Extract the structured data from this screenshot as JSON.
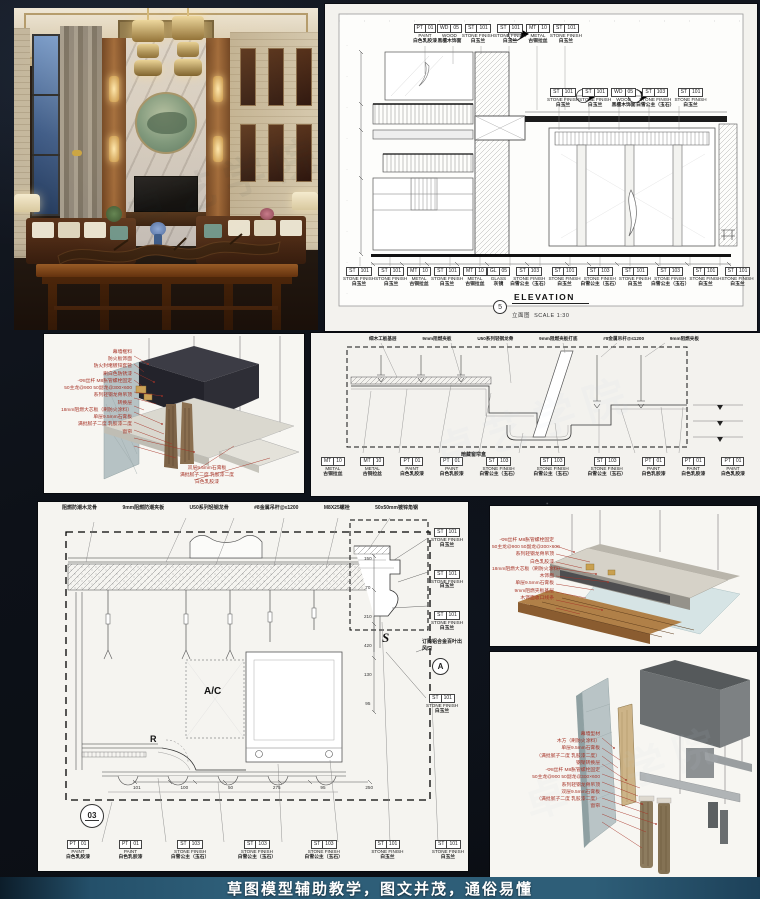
{
  "colors": {
    "background": "#0d1118",
    "panel_paper": "#f3f2ee",
    "banner_bg": "#2e5e78",
    "banner_text": "#ffffff",
    "annotation_red": "#a63226",
    "linework": "#222222"
  },
  "banner": {
    "text": "草图模型辅助教学，图文并茂，通俗易懂"
  },
  "watermark": {
    "text": "卓艺学院"
  },
  "elevation": {
    "title": "ELEVATION",
    "title_zh": "立面图",
    "scale": "SCALE 1:30",
    "detail_no": "5",
    "top_callouts": [
      {
        "c1": "PT",
        "c2": "01",
        "type": "PAINT",
        "zh": "白色乳胶漆"
      },
      {
        "c1": "WD",
        "c2": "05",
        "type": "WOOD",
        "zh": "黑檀木饰面"
      },
      {
        "c1": "ST",
        "c2": "101",
        "type": "STONE FINISH",
        "zh": "白玉兰"
      },
      {
        "c1": "ST",
        "c2": "101",
        "type": "STONE FINISH",
        "zh": "白玉兰"
      },
      {
        "c1": "MT",
        "c2": "10",
        "type": "METAL",
        "zh": "古铜拉丝"
      },
      {
        "c1": "ST",
        "c2": "101",
        "type": "STONE FINISH",
        "zh": "白玉兰"
      }
    ],
    "mid_callouts": [
      {
        "c1": "ST",
        "c2": "101",
        "type": "STONE FINISH",
        "zh": "白玉兰"
      },
      {
        "c1": "ST",
        "c2": "101",
        "type": "STONE FINISH",
        "zh": "白玉兰"
      },
      {
        "c1": "WD",
        "c2": "05",
        "type": "WOOD",
        "zh": "黑檀木饰面"
      },
      {
        "c1": "ST",
        "c2": "103",
        "type": "STONE FINISH",
        "zh": "白雪公主（玉石）"
      },
      {
        "c1": "ST",
        "c2": "101",
        "type": "STONE FINISH",
        "zh": "白玉兰"
      }
    ],
    "bottom_callouts": [
      {
        "c1": "ST",
        "c2": "101",
        "type": "STONE FINISH",
        "zh": "白玉兰"
      },
      {
        "c1": "ST",
        "c2": "101",
        "type": "STONE FINISH",
        "zh": "白玉兰"
      },
      {
        "c1": "MT",
        "c2": "10",
        "type": "METAL",
        "zh": "古铜拉丝"
      },
      {
        "c1": "ST",
        "c2": "101",
        "type": "STONE FINISH",
        "zh": "白玉兰"
      },
      {
        "c1": "MT",
        "c2": "10",
        "type": "METAL",
        "zh": "古铜拉丝"
      },
      {
        "c1": "GL",
        "c2": "05",
        "type": "GLASS",
        "zh": "灰镜"
      },
      {
        "c1": "ST",
        "c2": "103",
        "type": "STONE FINISH",
        "zh": "白雪公主（玉石）"
      },
      {
        "c1": "ST",
        "c2": "101",
        "type": "STONE FINISH",
        "zh": "白玉兰"
      },
      {
        "c1": "ST",
        "c2": "103",
        "type": "STONE FINISH",
        "zh": "白雪公主（玉石）"
      },
      {
        "c1": "ST",
        "c2": "101",
        "type": "STONE FINISH",
        "zh": "白玉兰"
      },
      {
        "c1": "ST",
        "c2": "103",
        "type": "STONE FINISH",
        "zh": "白雪公主（玉石）"
      },
      {
        "c1": "ST",
        "c2": "101",
        "type": "STONE FINISH",
        "zh": "白玉兰"
      },
      {
        "c1": "ST",
        "c2": "101",
        "type": "STONE FINISH",
        "zh": "白玉兰"
      }
    ]
  },
  "ceiling3d": {
    "annotations": [
      "幕墙框料",
      "防火板饰面",
      "防火封堵镀锌套管",
      "刷白色防锈漆",
      "-Φ8丝杆 M8胀管螺栓固定",
      "50主龙@900 50副龙@300×600",
      "系列轻钢龙骨吊顶",
      "转换层",
      "18mm阻燃大芯板（刷防火涂料）",
      "单层9.5mm石膏板",
      "满批腻子二度 乳胶漆二度",
      "窗帘"
    ],
    "note": [
      "双层9.5mm石膏板",
      "满批腻子二度 乳胶漆二度",
      "白色乳胶漆"
    ]
  },
  "section": {
    "top_labels": [
      "细木工板基层",
      "9mm阻燃夹板",
      "U50系列轻钢龙骨",
      "9mm阻燃夹板打底",
      "#8金属吊杆@≤1200",
      "9mm阻燃夹板"
    ],
    "note": "暗藏窗帘盒",
    "bottom_callouts": [
      {
        "c1": "MT",
        "c2": "10",
        "type": "METAL",
        "zh": "古铜拉丝"
      },
      {
        "c1": "MT",
        "c2": "10",
        "type": "METAL",
        "zh": "古铜拉丝"
      },
      {
        "c1": "PT",
        "c2": "01",
        "type": "PAINT",
        "zh": "白色乳胶漆"
      },
      {
        "c1": "PT",
        "c2": "01",
        "type": "PAINT",
        "zh": "白色乳胶漆"
      },
      {
        "c1": "ST",
        "c2": "103",
        "type": "STONE FINISH",
        "zh": "白雪公主（玉石）"
      },
      {
        "c1": "ST",
        "c2": "103",
        "type": "STONE FINISH",
        "zh": "白雪公主（玉石）"
      },
      {
        "c1": "ST",
        "c2": "103",
        "type": "STONE FINISH",
        "zh": "白雪公主（玉石）"
      },
      {
        "c1": "PT",
        "c2": "01",
        "type": "PAINT",
        "zh": "白色乳胶漆"
      },
      {
        "c1": "PT",
        "c2": "01",
        "type": "PAINT",
        "zh": "白色乳胶漆"
      },
      {
        "c1": "PT",
        "c2": "01",
        "type": "PAINT",
        "zh": "白色乳胶漆"
      }
    ]
  },
  "big_section": {
    "top_labels": [
      "阻燃防潮木龙骨",
      "9mm阻燃防潮夹板",
      "U50系列轻钢龙骨",
      "#8金属吊杆@≤1200",
      "M8X25螺栓",
      "50x50mm镀锌角钢"
    ],
    "right_callouts": [
      {
        "c1": "ST",
        "c2": "101",
        "type": "STONE FINISH",
        "zh": "白玉兰"
      },
      {
        "c1": "ST",
        "c2": "101",
        "type": "STONE FINISH",
        "zh": "白玉兰"
      },
      {
        "c1": "ST",
        "c2": "101",
        "type": "STONE FINISH",
        "zh": "白玉兰"
      }
    ],
    "lower_right_callout": {
      "c1": "ST",
      "c2": "101",
      "type": "STONE FINISH",
      "zh": "白玉兰"
    },
    "vent_label": "订购铝合金百叶出风口",
    "ac": "A/C",
    "r": "R",
    "s": "S",
    "detail_no": "03",
    "section_letter": "A",
    "bottom_callouts": [
      {
        "c1": "PT",
        "c2": "01",
        "type": "PAINT",
        "zh": "白色乳胶漆"
      },
      {
        "c1": "PT",
        "c2": "01",
        "type": "PAINT",
        "zh": "白色乳胶漆"
      },
      {
        "c1": "ST",
        "c2": "103",
        "type": "STONE FINISH",
        "zh": "白雪公主（玉石）"
      },
      {
        "c1": "ST",
        "c2": "103",
        "type": "STONE FINISH",
        "zh": "白雪公主（玉石）"
      },
      {
        "c1": "ST",
        "c2": "103",
        "type": "STONE FINISH",
        "zh": "白雪公主（玉石）"
      },
      {
        "c1": "ST",
        "c2": "101",
        "type": "STONE FINISH",
        "zh": "白玉兰"
      },
      {
        "c1": "ST",
        "c2": "101",
        "type": "STONE FINISH",
        "zh": "白玉兰"
      }
    ],
    "dims": [
      "101",
      "100",
      "50",
      "275",
      "95",
      "250"
    ],
    "vdims": [
      "150",
      "70",
      "210",
      "420",
      "130",
      "95"
    ]
  },
  "edge3d": {
    "annotations": [
      "-Φ8丝杆 M8胀管螺栓固定",
      "50主龙@900 50副龙@300×600",
      "系列轻钢龙骨吊顶",
      "白色乳胶漆",
      "18mm阻燃大芯板（刷防火涂料）",
      "木饰面",
      "单层9.5mm石膏板",
      "9mm阻燃夹板基层",
      "木饰面收口线条"
    ]
  },
  "wall3d": {
    "annotations": [
      "幕墙型材",
      "木方（刷防火涂料）",
      "单层9.5mm石膏板",
      "（满批腻子二度 乳胶漆二度）",
      "钢架转换层",
      "-Φ8丝杆 M8胀管螺栓固定",
      "50主龙@900 50副龙@300×600",
      "系列轻钢龙骨吊顶",
      "双层9.5mm石膏板",
      "（满批腻子二度 乳胶漆二度）",
      "窗帘"
    ]
  }
}
